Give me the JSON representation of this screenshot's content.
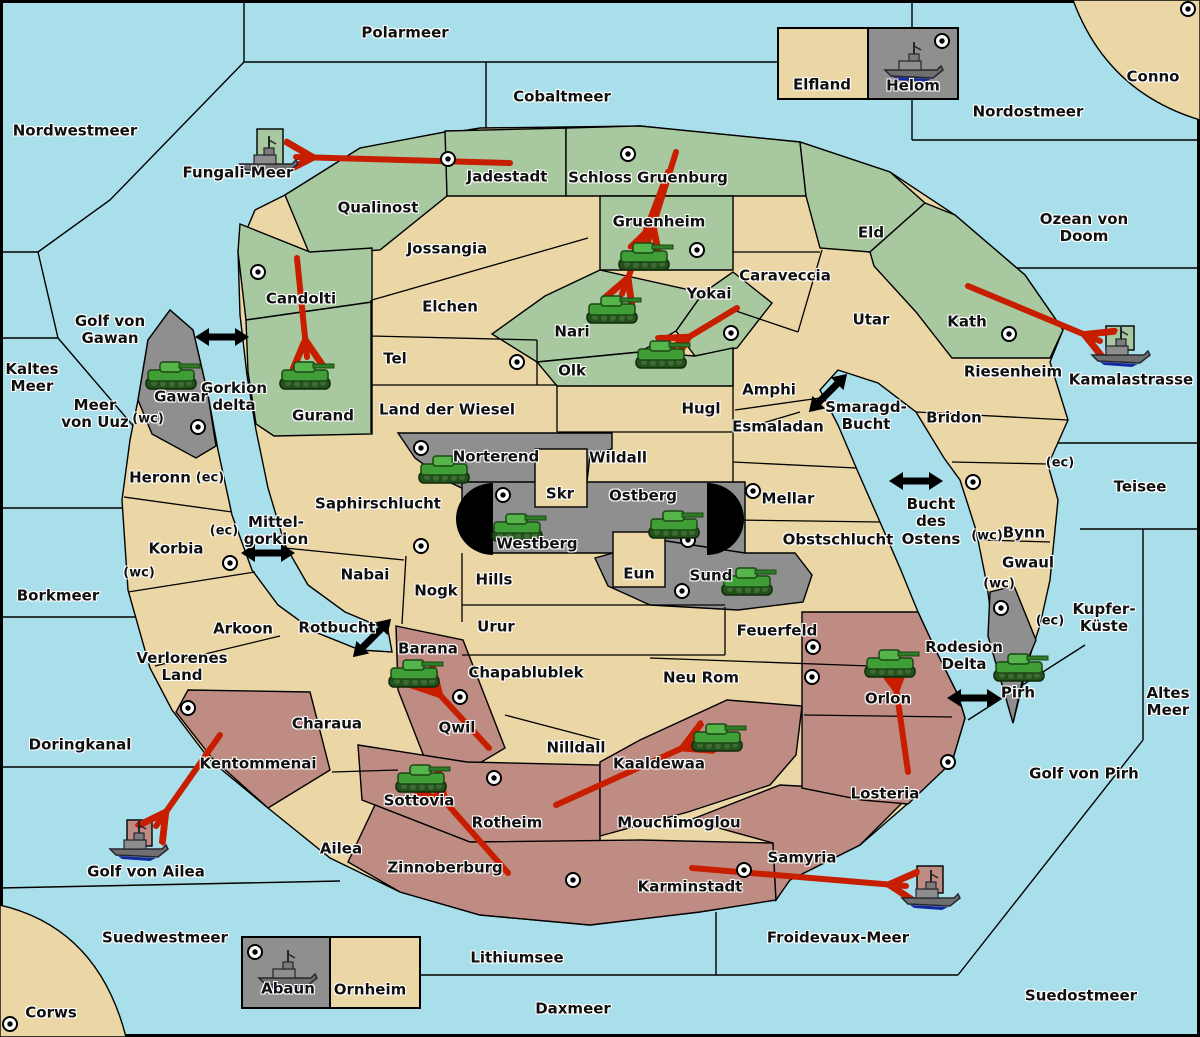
{
  "map": {
    "colors": {
      "sea": "#A9DFEA",
      "land_tan": "#EBD6A5",
      "land_green": "#A8C8A0",
      "land_rose": "#BF8C84",
      "land_gray": "#8F8F8F",
      "arrow_red": "#C81E00",
      "channel_arrow_black": "#000000",
      "ship_hull_blue": "#1428A0",
      "tank_green": "#3F9E36"
    },
    "sea_labels": [
      {
        "t": "Polarmeer",
        "x": 405,
        "y": 33
      },
      {
        "t": "Cobaltmeer",
        "x": 562,
        "y": 97
      },
      {
        "t": "Nordostmeer",
        "x": 1028,
        "y": 112
      },
      {
        "t": "Nordwestmeer",
        "x": 75,
        "y": 131
      },
      {
        "t": "Fungali-Meer",
        "x": 238,
        "y": 173
      },
      {
        "t": "Ozean von Doom",
        "x": 1084,
        "y": 228
      },
      {
        "t": "Golf von\nGawan",
        "x": 110,
        "y": 330
      },
      {
        "t": "Kaltes\nMeer",
        "x": 32,
        "y": 378
      },
      {
        "t": "Meer\nvon Uuz",
        "x": 95,
        "y": 414
      },
      {
        "t": "Kamalastrasse",
        "x": 1131,
        "y": 380
      },
      {
        "t": "Gorkion\ndelta",
        "x": 234,
        "y": 397
      },
      {
        "t": "Smaragd-\nBucht",
        "x": 866,
        "y": 416
      },
      {
        "t": "Teisee",
        "x": 1140,
        "y": 487
      },
      {
        "t": "Mittel-\ngorkion",
        "x": 276,
        "y": 531
      },
      {
        "t": "Bucht\ndes\nOstens",
        "x": 931,
        "y": 522
      },
      {
        "t": "Borkmeer",
        "x": 58,
        "y": 596
      },
      {
        "t": "Kupfer-\nKüste",
        "x": 1104,
        "y": 618
      },
      {
        "t": "Rotbucht",
        "x": 337,
        "y": 628
      },
      {
        "t": "Rodesion\nDelta",
        "x": 964,
        "y": 656
      },
      {
        "t": "Altes\nMeer",
        "x": 1168,
        "y": 702
      },
      {
        "t": "Doringkanal",
        "x": 80,
        "y": 745
      },
      {
        "t": "Golf von Pirh",
        "x": 1084,
        "y": 774
      },
      {
        "t": "Golf von Ailea",
        "x": 146,
        "y": 872
      },
      {
        "t": "Froidevaux-Meer",
        "x": 838,
        "y": 938
      },
      {
        "t": "Suedwestmeer",
        "x": 165,
        "y": 938
      },
      {
        "t": "Lithiumsee",
        "x": 517,
        "y": 958
      },
      {
        "t": "Suedostmeer",
        "x": 1081,
        "y": 996
      },
      {
        "t": "Daxmeer",
        "x": 573,
        "y": 1009
      }
    ],
    "territory_labels": [
      {
        "t": "Jadestadt",
        "x": 507,
        "y": 177
      },
      {
        "t": "Schloss Gruenburg",
        "x": 648,
        "y": 178
      },
      {
        "t": "Qualinost",
        "x": 378,
        "y": 208
      },
      {
        "t": "Elfland",
        "x": 822,
        "y": 85
      },
      {
        "t": "Helom",
        "x": 913,
        "y": 86
      },
      {
        "t": "Conno",
        "x": 1153,
        "y": 77
      },
      {
        "t": "Eld",
        "x": 871,
        "y": 233
      },
      {
        "t": "Gruenheim",
        "x": 659,
        "y": 222
      },
      {
        "t": "Jossangia",
        "x": 447,
        "y": 249
      },
      {
        "t": "Caraveccia",
        "x": 785,
        "y": 276
      },
      {
        "t": "Yokai",
        "x": 709,
        "y": 294
      },
      {
        "t": "Candolti",
        "x": 301,
        "y": 299
      },
      {
        "t": "Elchen",
        "x": 450,
        "y": 307
      },
      {
        "t": "Kath",
        "x": 967,
        "y": 322
      },
      {
        "t": "Utar",
        "x": 871,
        "y": 320
      },
      {
        "t": "Nari",
        "x": 572,
        "y": 332
      },
      {
        "t": "Olk",
        "x": 572,
        "y": 371
      },
      {
        "t": "Tel",
        "x": 395,
        "y": 359
      },
      {
        "t": "Riesenheim",
        "x": 1013,
        "y": 372
      },
      {
        "t": "Gurand",
        "x": 323,
        "y": 416
      },
      {
        "t": "Land der Wiesel",
        "x": 447,
        "y": 410
      },
      {
        "t": "Hugl",
        "x": 701,
        "y": 409
      },
      {
        "t": "Amphi",
        "x": 769,
        "y": 390
      },
      {
        "t": "Esmaladan",
        "x": 778,
        "y": 427
      },
      {
        "t": "Bridon",
        "x": 954,
        "y": 418
      },
      {
        "t": "Gawar",
        "x": 181,
        "y": 397
      },
      {
        "t": "Norterend",
        "x": 496,
        "y": 457
      },
      {
        "t": "Wildall",
        "x": 618,
        "y": 458
      },
      {
        "t": "Heronn",
        "x": 160,
        "y": 478
      },
      {
        "t": "Mellar",
        "x": 788,
        "y": 499
      },
      {
        "t": "Skr",
        "x": 560,
        "y": 494
      },
      {
        "t": "Ostberg",
        "x": 643,
        "y": 496
      },
      {
        "t": "Saphirschlucht",
        "x": 378,
        "y": 504
      },
      {
        "t": "Westberg",
        "x": 537,
        "y": 544
      },
      {
        "t": "Korbia",
        "x": 176,
        "y": 549
      },
      {
        "t": "Bynn",
        "x": 1024,
        "y": 533
      },
      {
        "t": "Gwaul",
        "x": 1028,
        "y": 563
      },
      {
        "t": "Obstschlucht",
        "x": 838,
        "y": 540
      },
      {
        "t": "Nabai",
        "x": 365,
        "y": 575
      },
      {
        "t": "Hills",
        "x": 494,
        "y": 580
      },
      {
        "t": "Nogk",
        "x": 436,
        "y": 591
      },
      {
        "t": "Eun",
        "x": 639,
        "y": 574
      },
      {
        "t": "Sund",
        "x": 711,
        "y": 576
      },
      {
        "t": "Urur",
        "x": 496,
        "y": 627
      },
      {
        "t": "Feuerfeld",
        "x": 777,
        "y": 631
      },
      {
        "t": "Arkoon",
        "x": 243,
        "y": 629
      },
      {
        "t": "Barana",
        "x": 428,
        "y": 649
      },
      {
        "t": "Verlorenes\nLand",
        "x": 182,
        "y": 667
      },
      {
        "t": "Chapablublek",
        "x": 526,
        "y": 673
      },
      {
        "t": "Neu Rom",
        "x": 701,
        "y": 678
      },
      {
        "t": "Charaua",
        "x": 327,
        "y": 724
      },
      {
        "t": "Kentommenai",
        "x": 258,
        "y": 764
      },
      {
        "t": "Qwil",
        "x": 457,
        "y": 728
      },
      {
        "t": "Nilldall",
        "x": 576,
        "y": 748
      },
      {
        "t": "Kaaldewaa",
        "x": 659,
        "y": 764
      },
      {
        "t": "Orlon",
        "x": 888,
        "y": 699
      },
      {
        "t": "Losteria",
        "x": 885,
        "y": 794
      },
      {
        "t": "Sottovia",
        "x": 419,
        "y": 801
      },
      {
        "t": "Rotheim",
        "x": 507,
        "y": 823
      },
      {
        "t": "Mouchimoglou",
        "x": 679,
        "y": 823
      },
      {
        "t": "Ailea",
        "x": 341,
        "y": 849
      },
      {
        "t": "Zinnoberburg",
        "x": 445,
        "y": 868
      },
      {
        "t": "Samyria",
        "x": 802,
        "y": 858
      },
      {
        "t": "Karminstadt",
        "x": 690,
        "y": 887
      },
      {
        "t": "Pirh",
        "x": 1018,
        "y": 693
      },
      {
        "t": "Abaun",
        "x": 288,
        "y": 989
      },
      {
        "t": "Ornheim",
        "x": 370,
        "y": 990
      },
      {
        "t": "Corws",
        "x": 51,
        "y": 1013
      }
    ],
    "coast_tags": [
      {
        "t": "(wc)",
        "x": 148,
        "y": 420
      },
      {
        "t": "(ec)",
        "x": 210,
        "y": 479
      },
      {
        "t": "(ec)",
        "x": 224,
        "y": 532
      },
      {
        "t": "(wc)",
        "x": 139,
        "y": 574
      },
      {
        "t": "(ec)",
        "x": 1060,
        "y": 464
      },
      {
        "t": "(wc)",
        "x": 987,
        "y": 537
      },
      {
        "t": "(wc)",
        "x": 999,
        "y": 585
      },
      {
        "t": "(ec)",
        "x": 1050,
        "y": 622
      }
    ],
    "offmap_boxes": [
      {
        "label": "Elfland",
        "x": 778,
        "y": 28,
        "w": 90,
        "h": 71,
        "color": "tan"
      },
      {
        "label": "Helom",
        "x": 868,
        "y": 28,
        "w": 90,
        "h": 71,
        "color": "gray"
      },
      {
        "label": "Abaun",
        "x": 242,
        "y": 937,
        "w": 88,
        "h": 71,
        "color": "gray"
      },
      {
        "label": "Ornheim",
        "x": 330,
        "y": 937,
        "w": 90,
        "h": 71,
        "color": "tan"
      }
    ],
    "supply_centers": [
      [
        448,
        159
      ],
      [
        628,
        154
      ],
      [
        942,
        41
      ],
      [
        1188,
        9
      ],
      [
        258,
        272
      ],
      [
        697,
        250
      ],
      [
        731,
        333
      ],
      [
        1009,
        334
      ],
      [
        517,
        362
      ],
      [
        198,
        427
      ],
      [
        421,
        448
      ],
      [
        503,
        495
      ],
      [
        688,
        540
      ],
      [
        753,
        491
      ],
      [
        682,
        591
      ],
      [
        230,
        563
      ],
      [
        973,
        482
      ],
      [
        1001,
        608
      ],
      [
        813,
        647
      ],
      [
        812,
        677
      ],
      [
        460,
        697
      ],
      [
        188,
        708
      ],
      [
        494,
        778
      ],
      [
        948,
        762
      ],
      [
        744,
        870
      ],
      [
        573,
        880
      ],
      [
        421,
        546
      ],
      [
        255,
        952
      ],
      [
        10,
        1024
      ]
    ],
    "tanks": [
      [
        172,
        374
      ],
      [
        306,
        374
      ],
      [
        645,
        255
      ],
      [
        613,
        308
      ],
      [
        662,
        353
      ],
      [
        445,
        468
      ],
      [
        518,
        526
      ],
      [
        675,
        523
      ],
      [
        748,
        580
      ],
      [
        415,
        672
      ],
      [
        422,
        777
      ],
      [
        718,
        736
      ],
      [
        891,
        662
      ],
      [
        1020,
        666
      ]
    ],
    "ships": [
      [
        268,
        156
      ],
      [
        913,
        62
      ],
      [
        1120,
        347
      ],
      [
        138,
        841
      ],
      [
        930,
        890
      ],
      [
        287,
        970
      ]
    ],
    "retreat_squares": [
      {
        "x": 257,
        "y": 129,
        "w": 26,
        "h": 37,
        "color": "green"
      },
      {
        "x": 1106,
        "y": 326,
        "w": 28,
        "h": 24,
        "color": "green"
      },
      {
        "x": 127,
        "y": 820,
        "w": 25,
        "h": 26,
        "color": "rose"
      },
      {
        "x": 917,
        "y": 866,
        "w": 26,
        "h": 27,
        "color": "rose"
      }
    ],
    "move_arrows": [
      [
        510,
        163,
        296,
        157
      ],
      [
        676,
        152,
        648,
        242
      ],
      [
        668,
        172,
        622,
        294
      ],
      [
        737,
        308,
        674,
        346
      ],
      [
        297,
        258,
        307,
        357
      ],
      [
        968,
        286,
        1100,
        341
      ],
      [
        220,
        735,
        156,
        826
      ],
      [
        489,
        748,
        428,
        682
      ],
      [
        508,
        873,
        434,
        789
      ],
      [
        556,
        805,
        698,
        741
      ],
      [
        908,
        772,
        894,
        673
      ],
      [
        692,
        868,
        906,
        886
      ]
    ],
    "channel_arrows": [
      {
        "x": 222,
        "y": 337,
        "r": 0
      },
      {
        "x": 268,
        "y": 553,
        "r": 0
      },
      {
        "x": 372,
        "y": 638,
        "r": -45
      },
      {
        "x": 828,
        "y": 393,
        "r": -45
      },
      {
        "x": 916,
        "y": 481,
        "r": 0
      },
      {
        "x": 974,
        "y": 698,
        "r": 0
      }
    ]
  }
}
